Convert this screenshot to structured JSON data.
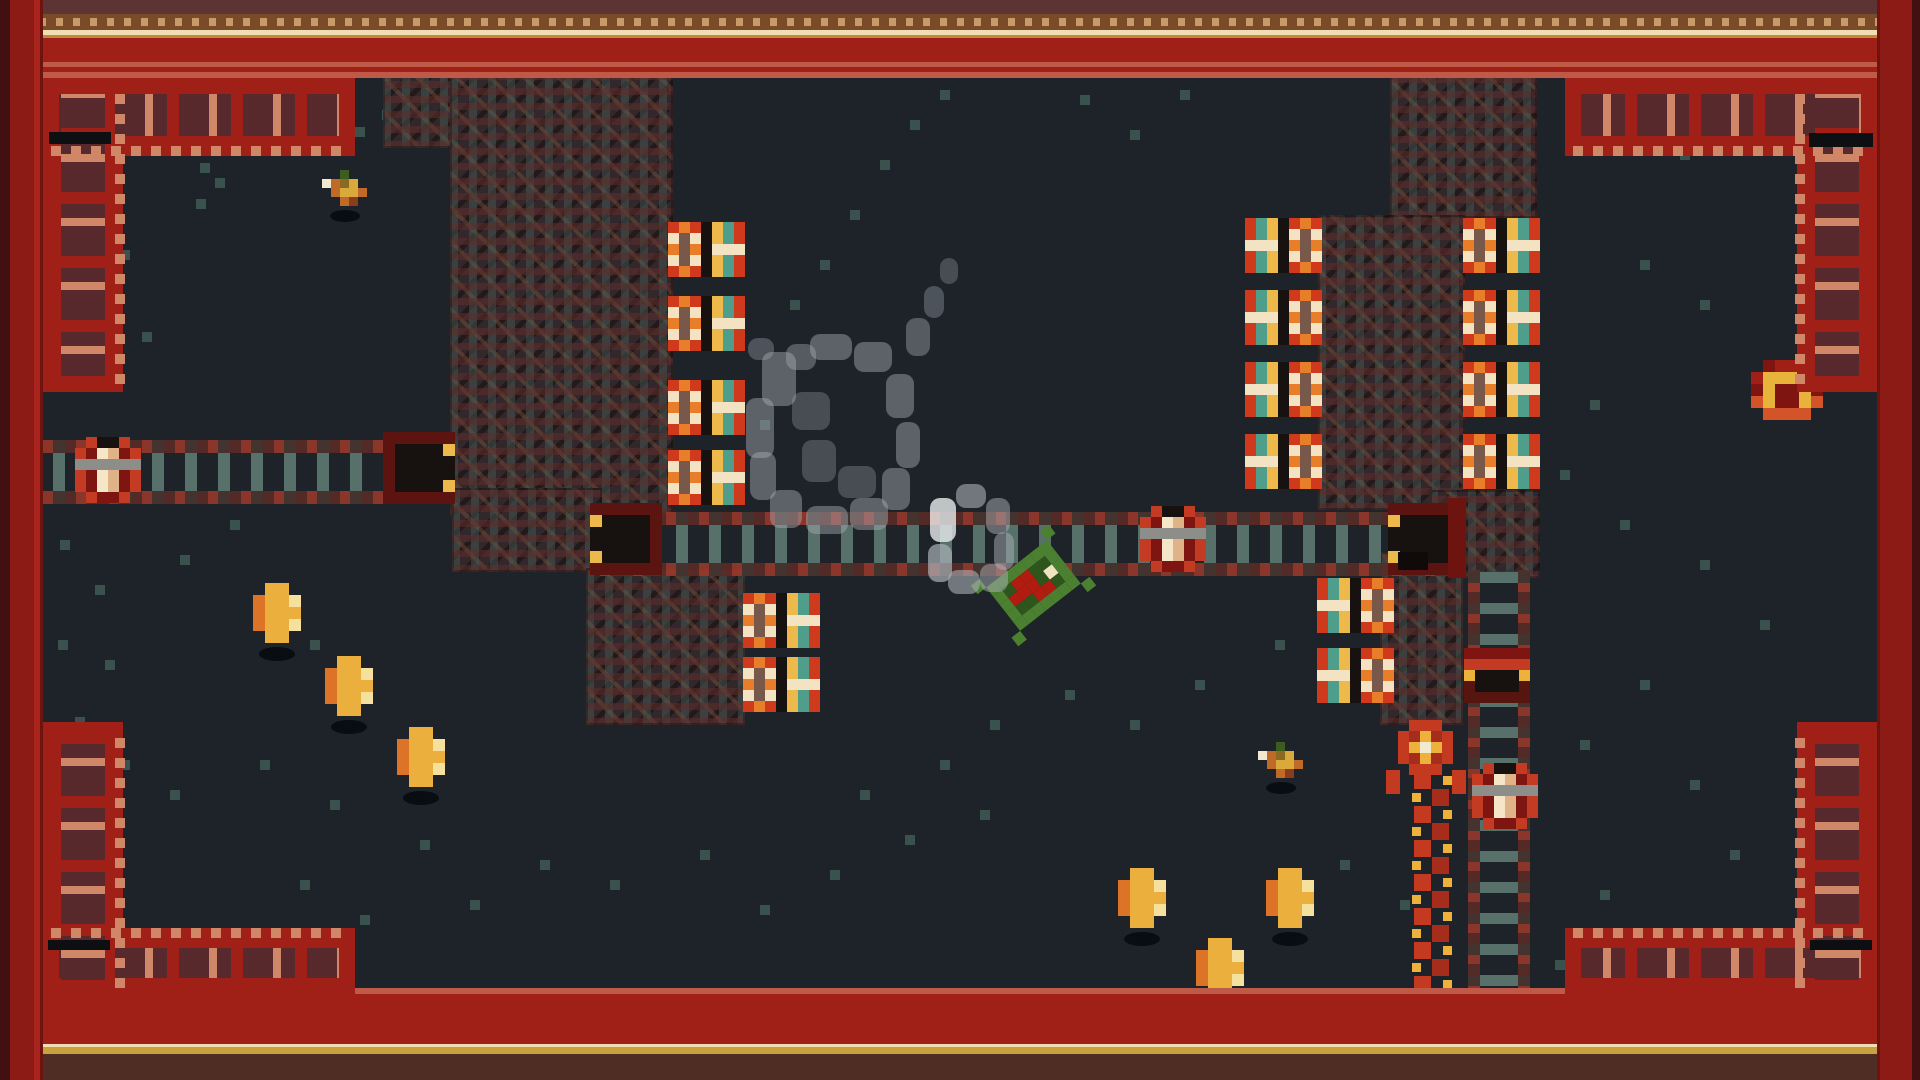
{
  "scene": {
    "width": 1920,
    "height": 1080,
    "floor_color": "#1d2329",
    "description": "top-down pixel-art cave room with rails, turrets, coins and a green handcar"
  },
  "palette": {
    "border_red": "#a02017",
    "border_red_dark": "#8a1a13",
    "border_dark_edge": "#421011",
    "border_salmon": "#bf5a49",
    "ornament_salmon": "#cf8767",
    "ornament_maroon": "#57282c",
    "cream_line": "#f0deb2",
    "gold_line": "#c9a23e",
    "dot_strip_bg": "#7a4b28",
    "dot_tan": "#c9996a",
    "top_dark_strip": "#5c3433",
    "bottom_dark_strip": "#4f2d24",
    "brick_base": "#32272a",
    "tie_teal": "#57706a",
    "tie_red": "#9e392a",
    "turret_red": "#cf3a1d",
    "turret_orange": "#e97e2a",
    "turret_cream": "#f3e3c2",
    "band_yellow": "#ecb94a",
    "band_teal": "#4f9d8b",
    "coin_gold": "#eaaf3c",
    "coin_orange": "#dd7327",
    "coin_highlight": "#f6e09e",
    "cart_green": "#4a8030",
    "cart_dark_green": "#2e551c",
    "cart_red": "#b01c10",
    "snake_red": "#c43a20",
    "snake_yellow": "#ecb23c",
    "smoke_gray": "#aab0b6",
    "speckle_teal": "#3e5a54",
    "door_gold": "#e8b33a",
    "pot_cream": "#f6e6c8"
  },
  "entities": {
    "structures": [
      [
        383,
        75,
        137,
        73
      ],
      [
        450,
        75,
        223,
        440
      ],
      [
        452,
        488,
        150,
        84
      ],
      [
        586,
        568,
        159,
        157
      ],
      [
        1390,
        75,
        147,
        143
      ],
      [
        1318,
        215,
        147,
        295
      ],
      [
        1430,
        490,
        110,
        88
      ],
      [
        1380,
        552,
        83,
        173
      ]
    ],
    "rails_h": [
      [
        43,
        440,
        412,
        64
      ],
      [
        600,
        512,
        860,
        64
      ]
    ],
    "rails_v": [
      [
        1468,
        570,
        62,
        425
      ]
    ],
    "tunnels": [
      {
        "x": 383,
        "y": 432,
        "facing": "right"
      },
      {
        "x": 590,
        "y": 503,
        "facing": "left"
      },
      {
        "x": 1388,
        "y": 503,
        "facing": "left"
      }
    ],
    "accents": [
      [
        1448,
        498,
        18,
        80,
        "#6e1410"
      ],
      [
        1398,
        552,
        30,
        18,
        "#100b0a"
      ]
    ],
    "turrets": [
      {
        "x": 668,
        "y": 222,
        "facing": "right"
      },
      {
        "x": 668,
        "y": 296,
        "facing": "right"
      },
      {
        "x": 668,
        "y": 380,
        "facing": "right"
      },
      {
        "x": 668,
        "y": 450,
        "facing": "right"
      },
      {
        "x": 743,
        "y": 593,
        "facing": "right"
      },
      {
        "x": 743,
        "y": 657,
        "facing": "right"
      },
      {
        "x": 1245,
        "y": 218,
        "facing": "left"
      },
      {
        "x": 1245,
        "y": 290,
        "facing": "left"
      },
      {
        "x": 1245,
        "y": 362,
        "facing": "left"
      },
      {
        "x": 1245,
        "y": 434,
        "facing": "left"
      },
      {
        "x": 1463,
        "y": 218,
        "facing": "right"
      },
      {
        "x": 1463,
        "y": 290,
        "facing": "right"
      },
      {
        "x": 1463,
        "y": 362,
        "facing": "right"
      },
      {
        "x": 1463,
        "y": 434,
        "facing": "right"
      },
      {
        "x": 1317,
        "y": 578,
        "facing": "left"
      },
      {
        "x": 1317,
        "y": 648,
        "facing": "left"
      }
    ],
    "pots": [
      [
        75,
        437
      ],
      [
        1140,
        506
      ],
      [
        1472,
        763
      ]
    ],
    "buffer_stop": {
      "x": 1464,
      "y": 648
    },
    "door": {
      "x": 1751,
      "y": 360
    },
    "snake": {
      "head": [
        1398,
        720
      ],
      "side_bits": [
        [
          1386,
          770,
          14,
          24
        ],
        [
          1452,
          770,
          14,
          24
        ]
      ],
      "chain_top": 772,
      "chain_bottom": 976,
      "x_left": 1414,
      "x_right": 1432,
      "seg": 17
    },
    "coins": [
      [
        253,
        583
      ],
      [
        325,
        656
      ],
      [
        397,
        727
      ],
      [
        1118,
        868
      ],
      [
        1266,
        868
      ],
      [
        1196,
        938
      ]
    ],
    "birds": [
      [
        322,
        170
      ],
      [
        1258,
        742
      ]
    ],
    "cart": {
      "x": 1033,
      "y": 585,
      "rotation_deg": -38
    },
    "smoke": [
      [
        762,
        352,
        34,
        54,
        0.45
      ],
      [
        746,
        398,
        28,
        60,
        0.45
      ],
      [
        750,
        452,
        26,
        48,
        0.45
      ],
      [
        770,
        490,
        32,
        38,
        0.45
      ],
      [
        806,
        506,
        42,
        28,
        0.45
      ],
      [
        850,
        498,
        38,
        32,
        0.45
      ],
      [
        882,
        468,
        28,
        42,
        0.45
      ],
      [
        896,
        422,
        24,
        46,
        0.45
      ],
      [
        886,
        374,
        28,
        44,
        0.45
      ],
      [
        854,
        342,
        38,
        30,
        0.45
      ],
      [
        810,
        334,
        42,
        26,
        0.45
      ],
      [
        786,
        344,
        30,
        26,
        0.4
      ],
      [
        792,
        392,
        38,
        38,
        0.3
      ],
      [
        802,
        440,
        34,
        42,
        0.3
      ],
      [
        838,
        466,
        38,
        32,
        0.3
      ],
      [
        906,
        318,
        24,
        38,
        0.4
      ],
      [
        924,
        286,
        20,
        32,
        0.35
      ],
      [
        940,
        258,
        18,
        26,
        0.3
      ],
      [
        748,
        338,
        26,
        22,
        0.35
      ],
      [
        930,
        498,
        26,
        44,
        0.8
      ],
      [
        928,
        544,
        24,
        38,
        0.7
      ],
      [
        948,
        570,
        32,
        24,
        0.6
      ],
      [
        980,
        564,
        28,
        28,
        0.5
      ],
      [
        994,
        532,
        20,
        38,
        0.5
      ],
      [
        986,
        498,
        24,
        36,
        0.5
      ],
      [
        956,
        484,
        30,
        24,
        0.6
      ]
    ],
    "speckles": [
      [
        345,
        95
      ],
      [
        382,
        110
      ],
      [
        355,
        127
      ],
      [
        200,
        163
      ],
      [
        215,
        178
      ],
      [
        196,
        199
      ],
      [
        120,
        250
      ],
      [
        86,
        300
      ],
      [
        142,
        332
      ],
      [
        98,
        372
      ],
      [
        60,
        540
      ],
      [
        95,
        585
      ],
      [
        58,
        640
      ],
      [
        105,
        660
      ],
      [
        75,
        717
      ],
      [
        230,
        520
      ],
      [
        180,
        555
      ],
      [
        260,
        610
      ],
      [
        310,
        640
      ],
      [
        120,
        760
      ],
      [
        170,
        790
      ],
      [
        260,
        760
      ],
      [
        330,
        800
      ],
      [
        420,
        840
      ],
      [
        300,
        880
      ],
      [
        360,
        915
      ],
      [
        470,
        900
      ],
      [
        540,
        860
      ],
      [
        610,
        880
      ],
      [
        700,
        850
      ],
      [
        760,
        905
      ],
      [
        830,
        870
      ],
      [
        905,
        835
      ],
      [
        980,
        810
      ],
      [
        1630,
        120
      ],
      [
        1680,
        150
      ],
      [
        1640,
        260
      ],
      [
        1700,
        300
      ],
      [
        1590,
        400
      ],
      [
        1560,
        470
      ],
      [
        1620,
        520
      ],
      [
        1700,
        560
      ],
      [
        1760,
        620
      ],
      [
        1640,
        680
      ],
      [
        1580,
        740
      ],
      [
        1690,
        780
      ],
      [
        1730,
        850
      ],
      [
        1600,
        890
      ],
      [
        1660,
        930
      ],
      [
        1275,
        640
      ],
      [
        1195,
        680
      ],
      [
        1130,
        720
      ],
      [
        1065,
        690
      ],
      [
        990,
        720
      ],
      [
        940,
        760
      ],
      [
        860,
        790
      ],
      [
        1340,
        860
      ],
      [
        1400,
        900
      ],
      [
        1555,
        960
      ],
      [
        760,
        420
      ],
      [
        790,
        300
      ],
      [
        820,
        260
      ],
      [
        850,
        210
      ],
      [
        880,
        160
      ],
      [
        910,
        120
      ],
      [
        940,
        90
      ],
      [
        1080,
        95
      ],
      [
        1130,
        130
      ],
      [
        1180,
        90
      ]
    ],
    "corner_shadows": [
      [
        49,
        132,
        62,
        12
      ],
      [
        1809,
        133,
        64,
        14
      ],
      [
        48,
        940,
        62,
        10
      ],
      [
        1810,
        940,
        62,
        10
      ]
    ]
  },
  "border": {
    "top_rows": [
      [
        "#5c3433",
        0,
        14
      ],
      [
        "dots",
        14,
        16
      ],
      [
        "#f0deb2",
        30,
        5
      ],
      [
        "#c08a3e",
        35,
        3
      ],
      [
        "#a02017",
        38,
        24
      ],
      [
        "#bf5a49",
        62,
        5
      ],
      [
        "#a02017",
        67,
        5
      ],
      [
        "#bf5a49",
        72,
        6
      ]
    ],
    "bottom_rows": [
      [
        "#bf5a49",
        988,
        6
      ],
      [
        "#a02017",
        994,
        50
      ],
      [
        "#f0deb2",
        1044,
        3
      ],
      [
        "#c9a23e",
        1047,
        7
      ],
      [
        "#4f2d24",
        1054,
        26
      ]
    ],
    "left_cols": [
      [
        "#421011",
        0,
        10
      ],
      [
        "#8c1a15",
        10,
        24
      ],
      [
        "#a8241c",
        34,
        6
      ],
      [
        "#6e1410",
        40,
        3
      ]
    ],
    "right_cols": [
      [
        "#6e1410",
        1877,
        3
      ],
      [
        "#8c1a15",
        1880,
        32
      ],
      [
        "#421011",
        1912,
        8
      ]
    ]
  }
}
